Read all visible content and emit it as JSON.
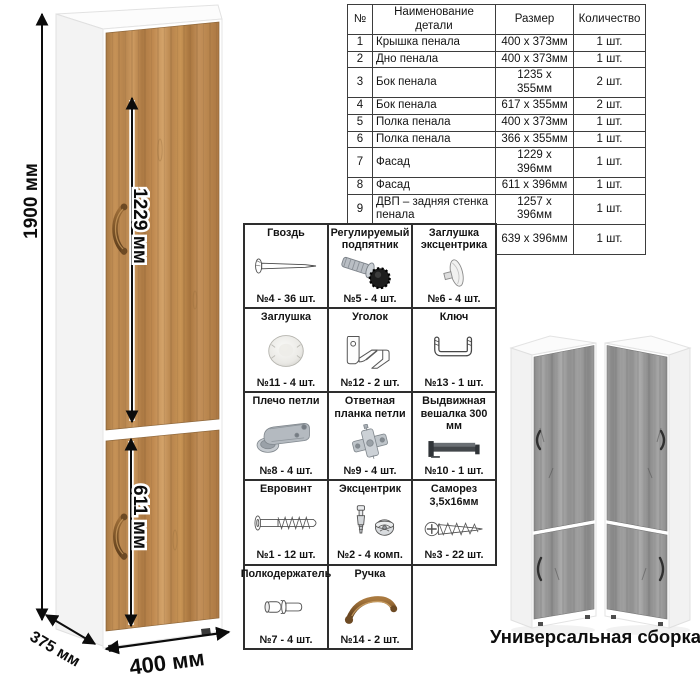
{
  "drawing": {
    "height_label": "1900 мм",
    "top_door_label": "1229 мм",
    "bottom_door_label": "611 мм",
    "depth_label": "375 мм",
    "width_label": "400 мм"
  },
  "parts_table": {
    "headers": {
      "num": "№",
      "name": "Наименование детали",
      "size": "Размер",
      "qty": "Количество"
    },
    "rows": [
      {
        "num": "1",
        "name": "Крышка пенала",
        "size": "400 х 373мм",
        "qty": "1 шт."
      },
      {
        "num": "2",
        "name": "Дно пенала",
        "size": "400 х 373мм",
        "qty": "1 шт."
      },
      {
        "num": "3",
        "name": "Бок пенала",
        "size": "1235 х 355мм",
        "qty": "2 шт."
      },
      {
        "num": "4",
        "name": "Бок пенала",
        "size": "617 х 355мм",
        "qty": "2 шт."
      },
      {
        "num": "5",
        "name": "Полка пенала",
        "size": "400 х 373мм",
        "qty": "1 шт."
      },
      {
        "num": "6",
        "name": "Полка пенала",
        "size": "366 х 355мм",
        "qty": "1 шт."
      },
      {
        "num": "7",
        "name": "Фасад",
        "size": "1229 х 396мм",
        "qty": "1 шт."
      },
      {
        "num": "8",
        "name": "Фасад",
        "size": "611 х 396мм",
        "qty": "1 шт."
      },
      {
        "num": "9",
        "name": "ДВП – задняя стенка пенала",
        "size": "1257 х 396мм",
        "qty": "1 шт."
      },
      {
        "num": "10",
        "name": "ДВП – задняя стенка пенала",
        "size": "639 х 396мм",
        "qty": "1 шт."
      }
    ]
  },
  "hardware": {
    "items": [
      {
        "title": "Гвоздь",
        "icon": "nail-icon",
        "count": "№4 - 36 шт."
      },
      {
        "title": "Регулируемый подпятник",
        "icon": "adjustable-foot-icon",
        "count": "№5 - 4 шт."
      },
      {
        "title": "Заглушка эксцентрика",
        "icon": "cam-cover-icon",
        "count": "№6 - 4 шт."
      },
      {
        "title": "Заглушка",
        "icon": "plug-cap-icon",
        "count": "№11 - 4 шт."
      },
      {
        "title": "Уголок",
        "icon": "corner-bracket-icon",
        "count": "№12 - 2 шт."
      },
      {
        "title": "Ключ",
        "icon": "hex-key-icon",
        "count": "№13 - 1 шт."
      },
      {
        "title": "Плечо петли",
        "icon": "hinge-arm-icon",
        "count": "№8 - 4 шт."
      },
      {
        "title": "Ответная планка петли",
        "icon": "hinge-plate-icon",
        "count": "№9 - 4 шт."
      },
      {
        "title": "Выдвижная вешалка 300 мм",
        "icon": "pullout-hanger-icon",
        "count": "№10 - 1 шт."
      },
      {
        "title": "Евровинт",
        "icon": "confirmat-screw-icon",
        "count": "№1 - 12 шт."
      },
      {
        "title": "Эксцентрик",
        "icon": "cam-lock-icon",
        "count": "№2 - 4 комп."
      },
      {
        "title": "Саморез 3,5х16мм",
        "icon": "self-tapping-screw-icon",
        "count": "№3 - 22 шт."
      },
      {
        "title": "Полкодержатель",
        "icon": "shelf-pin-icon",
        "count": "№7 - 4 шт."
      },
      {
        "title": "Ручка",
        "icon": "handle-icon",
        "count": "№14 - 2 шт."
      }
    ]
  },
  "footer": {
    "caption": "Универсальная сборка."
  },
  "colors": {
    "wood": "#b9854f",
    "wood_dark": "#9c7040",
    "wood_light": "#cfa169",
    "gray_wood": "#9c9c9c",
    "handle_bronze": "#8a5f33",
    "line": "#0c0c0c"
  }
}
